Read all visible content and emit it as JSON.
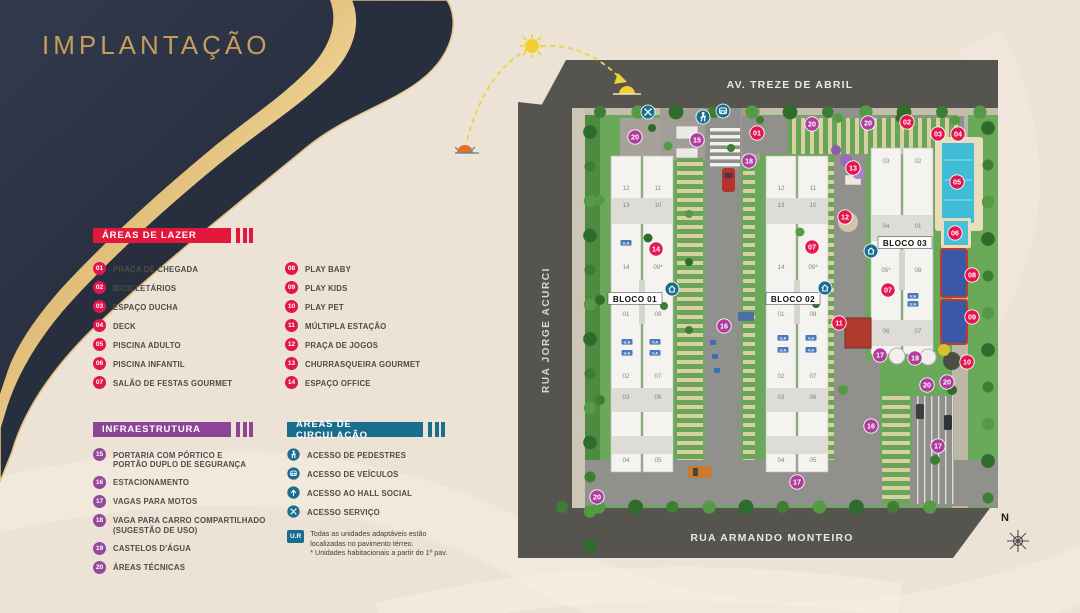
{
  "title": "IMPLANTAÇÃO",
  "legend_lazer": {
    "header": "ÁREAS DE LAZER",
    "color": "#e3173c",
    "badge_color": "#e0164e",
    "items": [
      {
        "num": "01",
        "label": "PRAÇA DE CHEGADA"
      },
      {
        "num": "02",
        "label": "BICICLETÁRIOS"
      },
      {
        "num": "03",
        "label": "ESPAÇO DUCHA"
      },
      {
        "num": "04",
        "label": "DECK"
      },
      {
        "num": "05",
        "label": "PISCINA ADULTO"
      },
      {
        "num": "06",
        "label": "PISCINA INFANTIL"
      },
      {
        "num": "07",
        "label": "SALÃO DE FESTAS GOURMET"
      },
      {
        "num": "08",
        "label": "PLAY BABY"
      },
      {
        "num": "09",
        "label": "PLAY KIDS"
      },
      {
        "num": "10",
        "label": "PLAY PET"
      },
      {
        "num": "11",
        "label": "MÚLTIPLA ESTAÇÃO"
      },
      {
        "num": "12",
        "label": "PRAÇA DE JOGOS"
      },
      {
        "num": "13",
        "label": "CHURRASQUEIRA GOURMET"
      },
      {
        "num": "14",
        "label": "ESPAÇO OFFICE"
      }
    ]
  },
  "legend_infra": {
    "header": "INFRAESTRUTURA",
    "color": "#8c4596",
    "badge_color": "#94499c",
    "items": [
      {
        "num": "15",
        "label": "PORTARIA COM PÓRTICO E\nPORTÃO DUPLO DE SEGURANÇA"
      },
      {
        "num": "16",
        "label": "ESTACIONAMENTO"
      },
      {
        "num": "17",
        "label": "VAGAS PARA MOTOS"
      },
      {
        "num": "18",
        "label": "VAGA PARA CARRO COMPARTILHADO\n(SUGESTÃO DE USO)"
      },
      {
        "num": "19",
        "label": "CASTELOS D'ÁGUA"
      },
      {
        "num": "20",
        "label": "ÁREAS TÉCNICAS"
      }
    ]
  },
  "legend_circ": {
    "header": "ÁREAS DE CIRCULAÇÃO",
    "color": "#1b6d8e",
    "items": [
      {
        "icon": "pedestrian-icon",
        "ref": "ic-ped",
        "label": "ACESSO DE PEDESTRES"
      },
      {
        "icon": "vehicle-icon",
        "ref": "ic-car",
        "label": "ACESSO DE VEÍCULOS"
      },
      {
        "icon": "hall-icon",
        "ref": "ic-hall",
        "label": "ACESSO AO HALL SOCIAL"
      },
      {
        "icon": "service-icon",
        "ref": "ic-serv",
        "label": "ACESSO SERVIÇO"
      }
    ]
  },
  "note": {
    "badge": "U.R",
    "line1": "Todas as unidades adaptáveis estão",
    "line2": "localizadas no pavimento térreo.",
    "line3": "* Unidades habitacionais a partir do 1º pav."
  },
  "map": {
    "streets": {
      "top": "AV. TREZE DE ABRIL",
      "left": "RUA JORGE ACURCI",
      "bottom": "RUA ARMANDO MONTEIRO"
    },
    "compass": "N",
    "colors": {
      "red": "#e8114b",
      "purple": "#b03aa0",
      "teal": "#1b6d8e"
    },
    "blocks": [
      {
        "label": "BLOCO 01",
        "x": 635,
        "y": 299
      },
      {
        "label": "BLOCO 02",
        "x": 793,
        "y": 299
      },
      {
        "label": "BLOCO 03",
        "x": 905,
        "y": 243
      }
    ],
    "badges": [
      {
        "n": "20",
        "x": 635,
        "y": 137,
        "c": "p"
      },
      {
        "n": "15",
        "x": 697,
        "y": 140,
        "c": "p"
      },
      {
        "n": "01",
        "x": 757,
        "y": 133,
        "c": "r"
      },
      {
        "n": "18",
        "x": 749,
        "y": 161,
        "c": "p"
      },
      {
        "n": "20",
        "x": 812,
        "y": 124,
        "c": "p"
      },
      {
        "n": "20",
        "x": 868,
        "y": 123,
        "c": "p"
      },
      {
        "n": "02",
        "x": 907,
        "y": 122,
        "c": "r"
      },
      {
        "n": "03",
        "x": 938,
        "y": 134,
        "c": "r"
      },
      {
        "n": "04",
        "x": 958,
        "y": 134,
        "c": "r"
      },
      {
        "n": "05",
        "x": 957,
        "y": 182,
        "c": "r"
      },
      {
        "n": "06",
        "x": 955,
        "y": 233,
        "c": "r"
      },
      {
        "n": "13",
        "x": 853,
        "y": 168,
        "c": "r"
      },
      {
        "n": "12",
        "x": 845,
        "y": 217,
        "c": "r"
      },
      {
        "n": "07",
        "x": 812,
        "y": 247,
        "c": "r"
      },
      {
        "n": "14",
        "x": 656,
        "y": 249,
        "c": "r"
      },
      {
        "n": "07",
        "x": 888,
        "y": 290,
        "c": "r"
      },
      {
        "n": "08",
        "x": 972,
        "y": 275,
        "c": "r"
      },
      {
        "n": "09",
        "x": 972,
        "y": 317,
        "c": "r"
      },
      {
        "n": "11",
        "x": 839,
        "y": 323,
        "c": "r"
      },
      {
        "n": "10",
        "x": 967,
        "y": 362,
        "c": "r"
      },
      {
        "n": "16",
        "x": 724,
        "y": 326,
        "c": "p"
      },
      {
        "n": "17",
        "x": 880,
        "y": 355,
        "c": "p"
      },
      {
        "n": "19",
        "x": 915,
        "y": 358,
        "c": "p"
      },
      {
        "n": "20",
        "x": 927,
        "y": 385,
        "c": "p"
      },
      {
        "n": "20",
        "x": 947,
        "y": 382,
        "c": "p"
      },
      {
        "n": "16",
        "x": 871,
        "y": 426,
        "c": "p"
      },
      {
        "n": "17",
        "x": 938,
        "y": 446,
        "c": "p"
      },
      {
        "n": "17",
        "x": 797,
        "y": 482,
        "c": "p"
      },
      {
        "n": "20",
        "x": 597,
        "y": 497,
        "c": "p"
      }
    ],
    "units": [
      {
        "t": "12",
        "x": 626,
        "y": 190
      },
      {
        "t": "11",
        "x": 658,
        "y": 190
      },
      {
        "t": "13",
        "x": 626,
        "y": 207
      },
      {
        "t": "10",
        "x": 658,
        "y": 207
      },
      {
        "t": "14",
        "x": 626,
        "y": 269
      },
      {
        "t": "09*",
        "x": 658,
        "y": 269
      },
      {
        "t": "01",
        "x": 626,
        "y": 316
      },
      {
        "t": "08",
        "x": 658,
        "y": 316
      },
      {
        "t": "02",
        "x": 626,
        "y": 378
      },
      {
        "t": "07",
        "x": 658,
        "y": 378
      },
      {
        "t": "03",
        "x": 626,
        "y": 399
      },
      {
        "t": "06",
        "x": 658,
        "y": 399
      },
      {
        "t": "04",
        "x": 626,
        "y": 462
      },
      {
        "t": "05",
        "x": 658,
        "y": 462
      },
      {
        "t": "12",
        "x": 781,
        "y": 190
      },
      {
        "t": "11",
        "x": 813,
        "y": 190
      },
      {
        "t": "13",
        "x": 781,
        "y": 207
      },
      {
        "t": "10",
        "x": 813,
        "y": 207
      },
      {
        "t": "14",
        "x": 781,
        "y": 269
      },
      {
        "t": "09*",
        "x": 813,
        "y": 269
      },
      {
        "t": "01",
        "x": 781,
        "y": 316
      },
      {
        "t": "08",
        "x": 813,
        "y": 316
      },
      {
        "t": "02",
        "x": 781,
        "y": 378
      },
      {
        "t": "07",
        "x": 813,
        "y": 378
      },
      {
        "t": "03",
        "x": 781,
        "y": 399
      },
      {
        "t": "06",
        "x": 813,
        "y": 399
      },
      {
        "t": "04",
        "x": 781,
        "y": 462
      },
      {
        "t": "05",
        "x": 813,
        "y": 462
      },
      {
        "t": "03",
        "x": 886,
        "y": 163
      },
      {
        "t": "02",
        "x": 918,
        "y": 163
      },
      {
        "t": "04",
        "x": 886,
        "y": 228
      },
      {
        "t": "01",
        "x": 918,
        "y": 228
      },
      {
        "t": "05*",
        "x": 886,
        "y": 272
      },
      {
        "t": "08",
        "x": 918,
        "y": 272
      },
      {
        "t": "06",
        "x": 886,
        "y": 333
      },
      {
        "t": "07",
        "x": 918,
        "y": 333
      }
    ],
    "tags": [
      {
        "t": "U.A",
        "x": 626,
        "y": 243
      },
      {
        "t": "U.A",
        "x": 627,
        "y": 342
      },
      {
        "t": "V.A",
        "x": 655,
        "y": 342
      },
      {
        "t": "U.A",
        "x": 627,
        "y": 353
      },
      {
        "t": "V.A",
        "x": 655,
        "y": 353
      },
      {
        "t": "U.A",
        "x": 783,
        "y": 338
      },
      {
        "t": "V.A",
        "x": 811,
        "y": 338
      },
      {
        "t": "U.A",
        "x": 783,
        "y": 350
      },
      {
        "t": "V.A",
        "x": 811,
        "y": 350
      },
      {
        "t": "V.A",
        "x": 913,
        "y": 296
      },
      {
        "t": "U.A",
        "x": 913,
        "y": 304
      }
    ],
    "access_icons": [
      {
        "icon": "service-icon",
        "ref": "ic-serv",
        "x": 648,
        "y": 112
      },
      {
        "icon": "pedestrian-icon",
        "ref": "ic-ped",
        "x": 703,
        "y": 117
      },
      {
        "icon": "vehicle-icon",
        "ref": "ic-car",
        "x": 723,
        "y": 111
      },
      {
        "icon": "hall-icon",
        "ref": "ic-house",
        "x": 672,
        "y": 289
      },
      {
        "icon": "hall-icon",
        "ref": "ic-house",
        "x": 825,
        "y": 288
      },
      {
        "icon": "hall-icon",
        "ref": "ic-house",
        "x": 871,
        "y": 251
      }
    ]
  }
}
